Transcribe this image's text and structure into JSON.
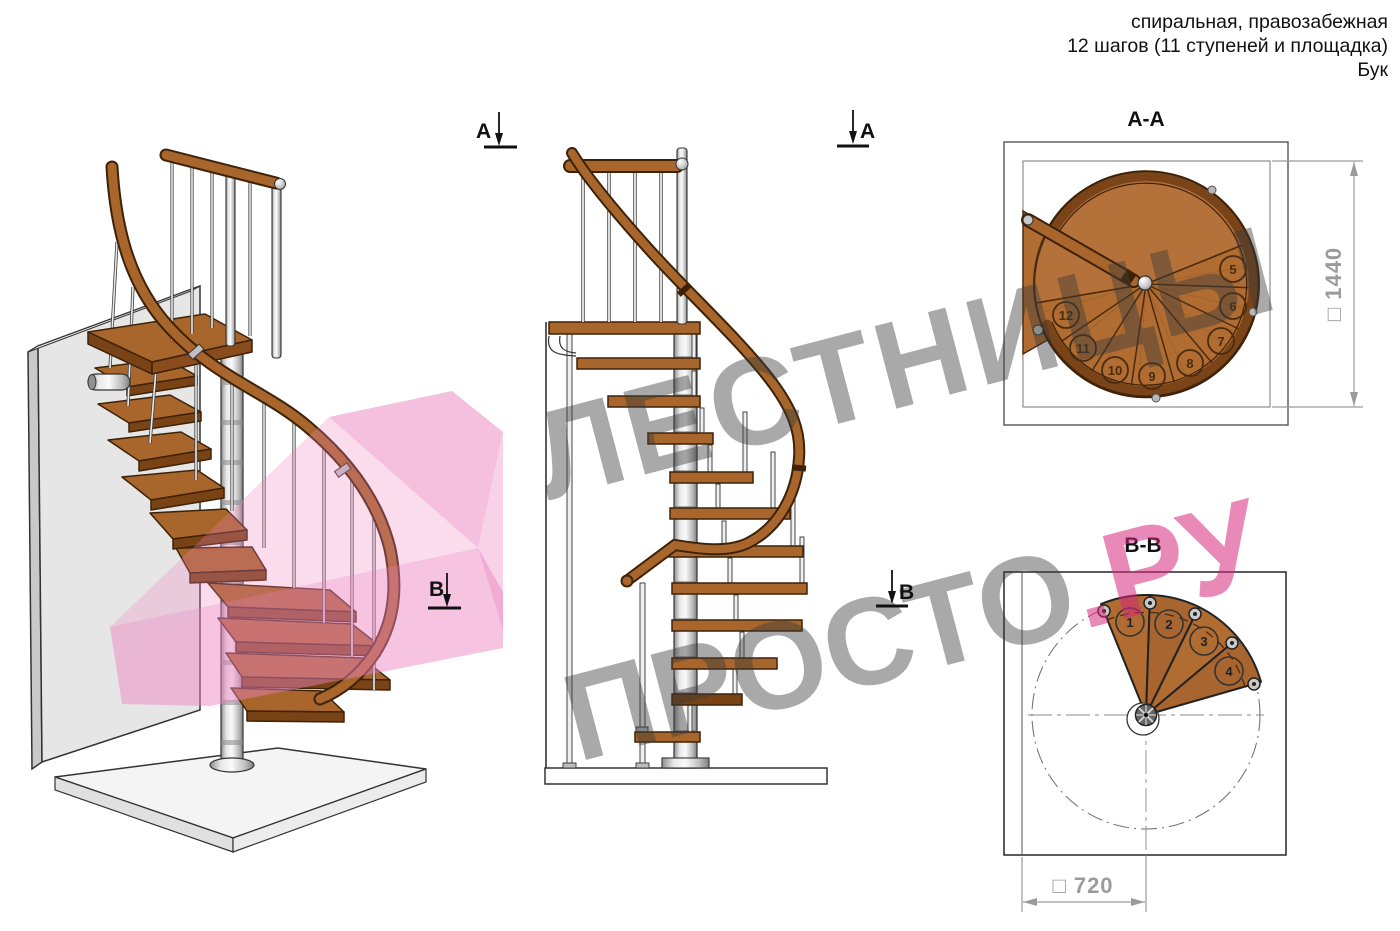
{
  "header": {
    "line1": "спиральная, правозабежная",
    "line2": "12 шагов (11 ступеней и площадка)",
    "line3": "Бук"
  },
  "watermark": {
    "line1": "ЛЕСТНИЦЫ",
    "line2_gray": "ПРОСТО",
    "line2_accent": ".РУ",
    "gray_color": "#9a9a9a",
    "accent_color": "#e8308a"
  },
  "section_markers": {
    "a": "A",
    "b": "B"
  },
  "section_a": {
    "title": "А-А",
    "dimension_label": "□ 1440",
    "step_numbers": [
      5,
      6,
      7,
      8,
      9,
      10,
      11,
      12
    ]
  },
  "section_b": {
    "title": "В-В",
    "dimension_label": "□ 720",
    "step_numbers": [
      1,
      2,
      3,
      4
    ]
  },
  "colors": {
    "wood": "#a8662c",
    "wood_dark": "#5f3310",
    "outline": "#3d2208",
    "metal": "#d9d9d9",
    "wall": "#e4e4e4",
    "dim_gray": "#9b9b9b",
    "pink_overlay": "#ec82be"
  }
}
